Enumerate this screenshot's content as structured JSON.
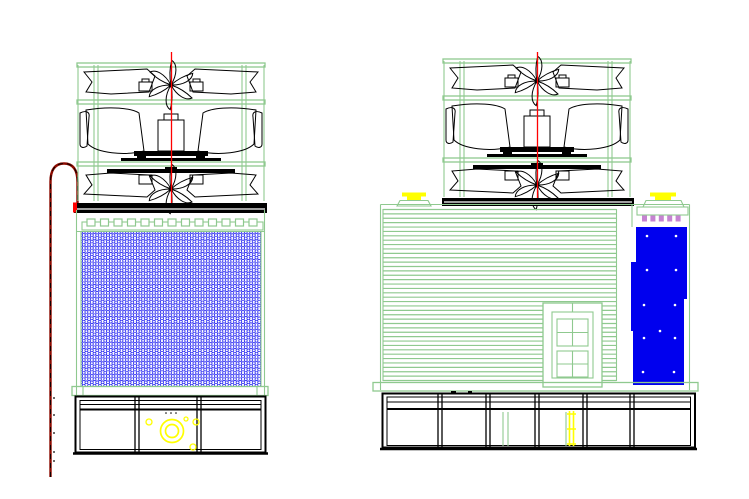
{
  "drawing": {
    "kind": "cad-cooling-tower-elevations",
    "view_count": 2
  },
  "colors": {
    "green": "#8fc98f",
    "cad_blue": "#0000ee",
    "yellow": "#ffff00",
    "purple": "#c583d1",
    "red": "#ff0000",
    "pipe_red": "#8b0a00",
    "black": "#000000",
    "white": "#ffffff"
  },
  "front_view": {
    "railing": {
      "post_count": 13,
      "x_start": 87,
      "spacing": 13.5,
      "post_width": 8,
      "post_height": 7,
      "y": 219
    },
    "basin": {
      "sections": 3,
      "divider_x": [
        137,
        199
      ],
      "top": 397,
      "bottom": 452
    },
    "pump": {
      "main": {
        "cx": 172,
        "cy": 431,
        "r_outer": 11.5,
        "r_inner": 6.5
      },
      "small_circles": [
        {
          "cx": 149,
          "cy": 422,
          "r": 3
        },
        {
          "cx": 186,
          "cy": 419,
          "r": 2
        },
        {
          "cx": 196,
          "cy": 422,
          "r": 3
        },
        {
          "cx": 193,
          "cy": 447,
          "r": 3
        }
      ],
      "dots": [
        [
          166,
          413
        ],
        [
          171,
          413
        ],
        [
          176,
          413
        ]
      ]
    },
    "pipe_ticks": [
      [
        54,
        398
      ],
      [
        54,
        415
      ],
      [
        54,
        433
      ],
      [
        54,
        452
      ],
      [
        54,
        461
      ]
    ]
  },
  "side_view": {
    "louvers": {
      "count": 40,
      "x1": 383,
      "x2": 616.5,
      "y_start": 209.5,
      "y_end": 380.5
    },
    "basin": {
      "sections": 6,
      "divider_x": [
        440,
        488,
        537,
        585,
        632
      ],
      "top": 394,
      "bottom": 447
    },
    "vents": {
      "count": 5,
      "x_start": 642,
      "spacing": 8.4,
      "width": 5,
      "height": 6,
      "y": 215.5
    },
    "panel_dots": [
      [
        647,
        236
      ],
      [
        676,
        236
      ],
      [
        647,
        270
      ],
      [
        676,
        270
      ],
      [
        644,
        305
      ],
      [
        675,
        305
      ],
      [
        660,
        331
      ],
      [
        644,
        338
      ],
      [
        675,
        338
      ],
      [
        643,
        372
      ],
      [
        674,
        372
      ]
    ]
  }
}
